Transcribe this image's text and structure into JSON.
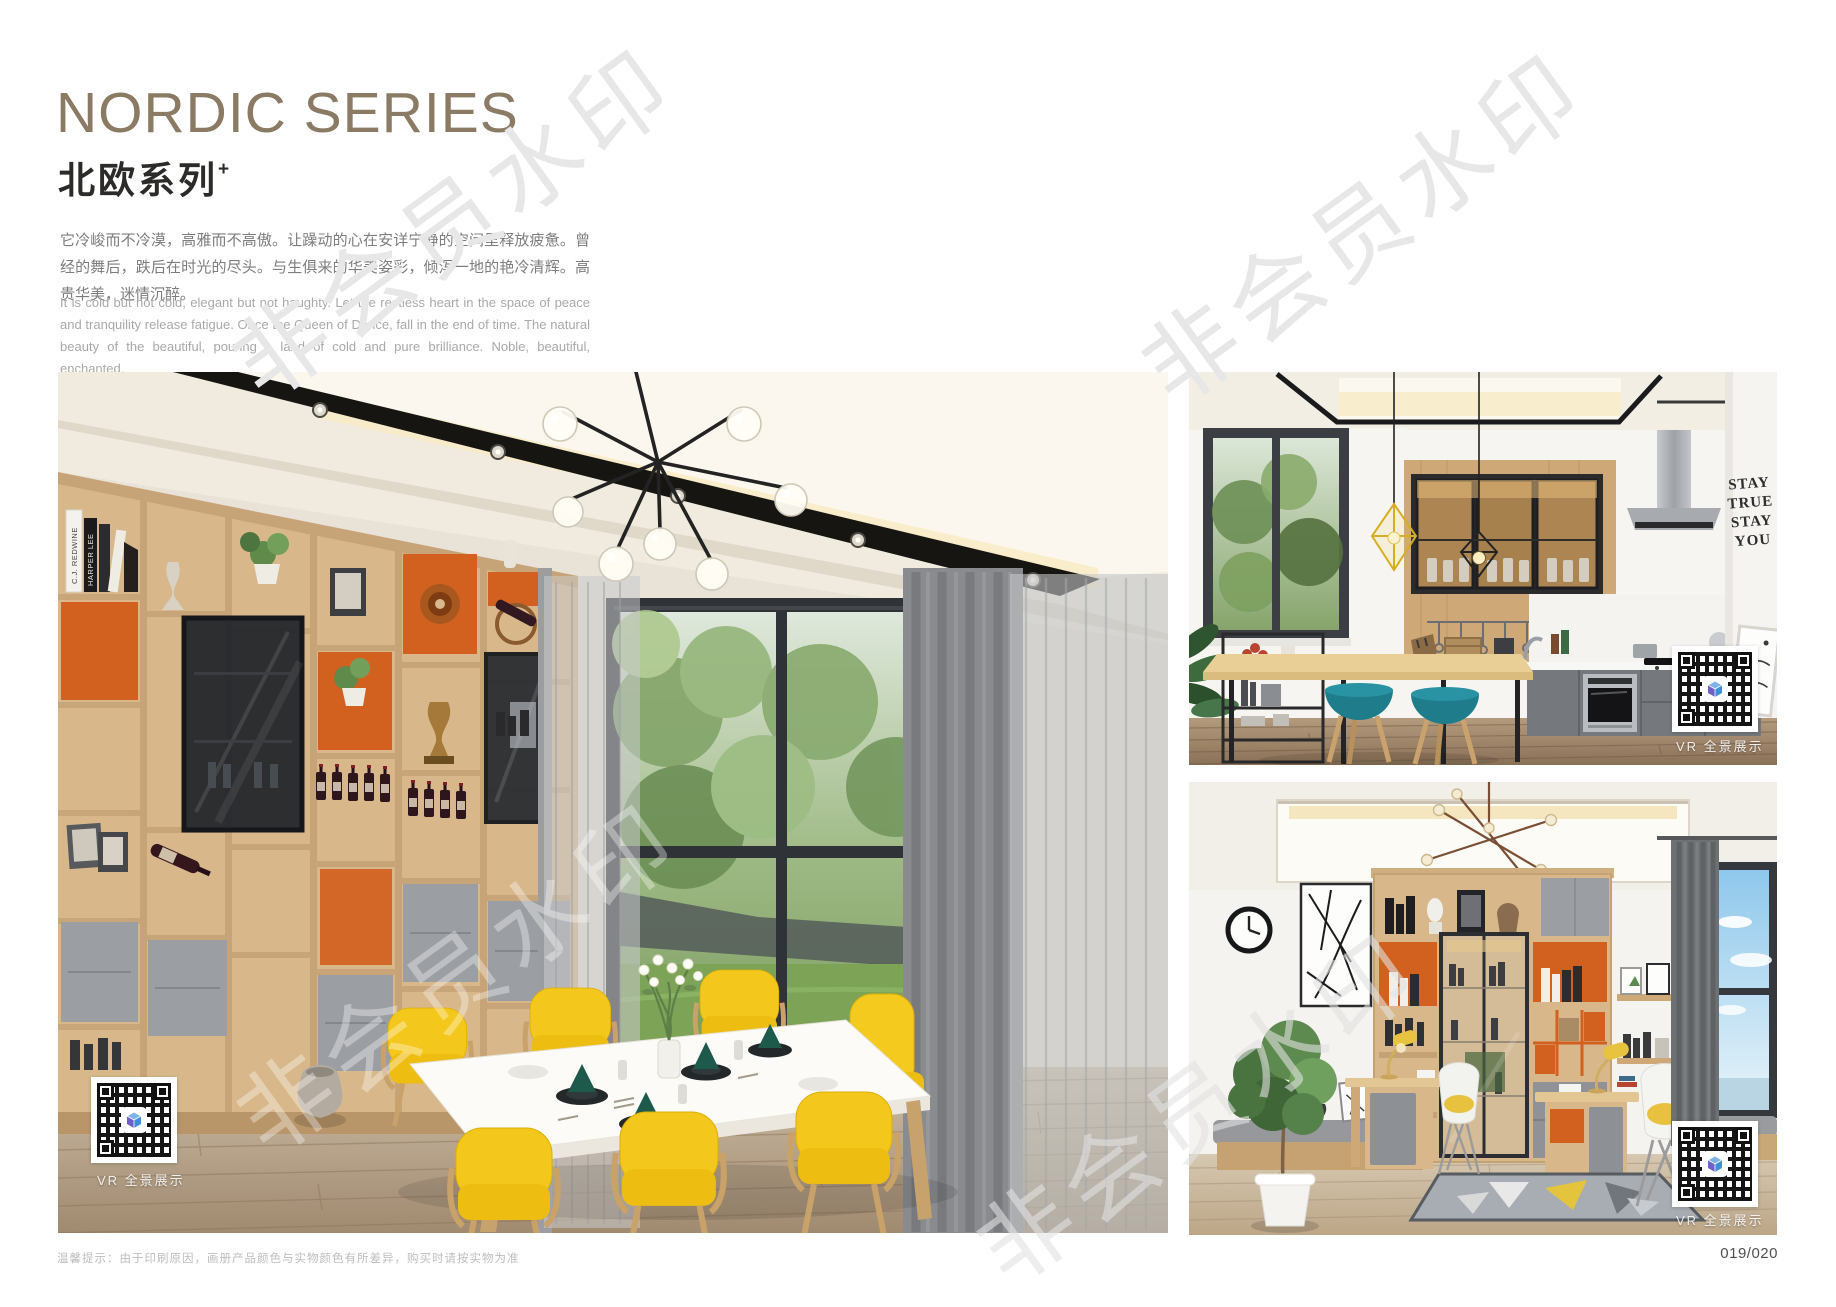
{
  "page": {
    "title_en": "NORDIC SERIES",
    "title_zh": "北欧系列",
    "title_sup": "+",
    "desc_zh": "它冷峻而不冷漠，高雅而不高傲。让躁动的心在安详宁静的空间里释放疲惫。曾经的舞后，跌后在时光的尽头。与生俱来的华美姿彩，倾泻一地的艳冷清辉。高贵华美，迷情沉醉。",
    "desc_en": "It is cold but not cold, elegant but not haughty. Let the restless heart in the space of peace and tranquility release fatigue. Once the Queen of Dance, fall in the end of time. The natural beauty of the beautiful, pouring a land of cold and pure brilliance. Noble, beautiful, enchanted.",
    "watermark": "非会员水印",
    "footer_note": "温馨提示：由于印刷原因，画册产品颜色与实物颜色有所差异，购买时请按实物为准",
    "page_number": "019/020"
  },
  "photos": {
    "vr_label": "VR 全景展示",
    "wall_art": [
      "STAY",
      "TRUE",
      "STAY",
      "YOU"
    ],
    "book_spines": [
      "C.J. REDWINE",
      "HARPER LEE"
    ]
  },
  "colors": {
    "title_accent": "#8b7a64",
    "shelf_wood": "#d8b88b",
    "accent_orange": "#d2601f",
    "chair_yellow": "#f2c51a",
    "stool_teal": "#1f7c8a"
  }
}
